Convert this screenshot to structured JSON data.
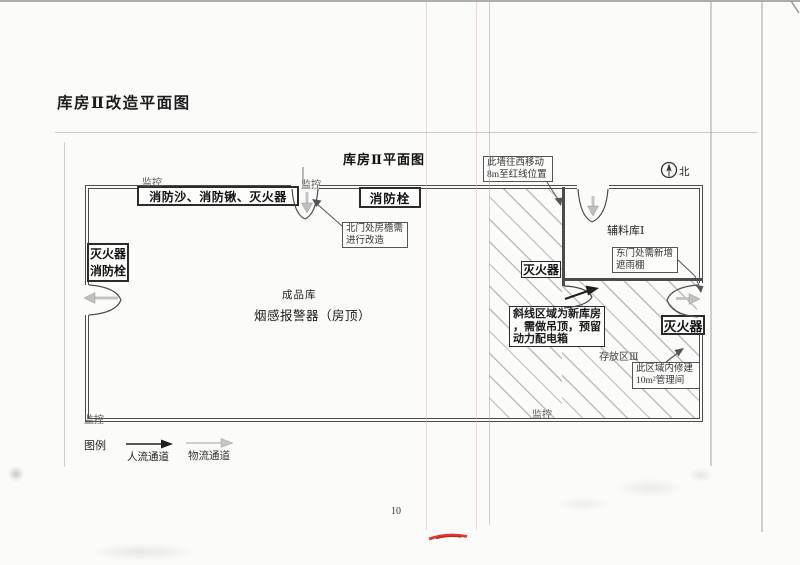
{
  "page": {
    "title": "库房Ⅱ改造平面图",
    "page_number": "10"
  },
  "diagram": {
    "title": "库房Ⅱ平面图",
    "north_label": "北",
    "rooms": {
      "finished_goods": "成品库",
      "smoke_detector_note": "烟感报警器（房顶）",
      "aux_warehouse": "辅料库Ⅰ",
      "storage_area_3": "存放区Ⅲ"
    },
    "equipment": {
      "fire_sand_shovel_ext": "消防沙、消防锹、灭火器",
      "hydrant_north": "消防栓",
      "left_combo_line1": "灭火器",
      "left_combo_line2": "消防栓",
      "extinguisher_mid": "灭火器",
      "extinguisher_east": "灭火器"
    },
    "annotations": {
      "north_eave": {
        "line1": "北门处房檐需",
        "line2": "进行改造"
      },
      "wall_move": {
        "line1": "此墙往西移动",
        "line2": "8m至红线位置"
      },
      "east_canopy": {
        "line1": "东门处需新增",
        "line2": "遮雨棚"
      },
      "hatch_note": {
        "line1": "斜线区域为新库房",
        "line2": "，需做吊顶，预留",
        "line3": "动力配电箱"
      },
      "mgmt_room": {
        "line1": "此区域内修建",
        "line2": "10m²管理间"
      }
    },
    "monitors": {
      "top_left": "监控",
      "north_door": "监控",
      "bottom_left": "监控",
      "bottom_mid": "监控"
    }
  },
  "legend": {
    "title": "图例",
    "people_flow": "人流通道",
    "logistics_flow": "物流通道"
  },
  "colors": {
    "wall": "#4c4c4c",
    "hatch_line": "#bcbcbc",
    "people_arrow": "#1f1f1f",
    "logistics_arrow": "#c0c0c0",
    "red_mark": "#d6281e"
  }
}
